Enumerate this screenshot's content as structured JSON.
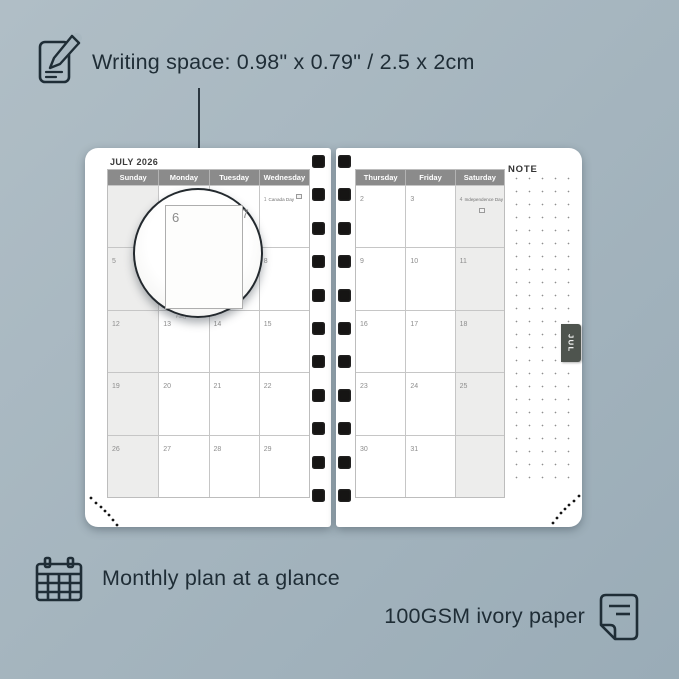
{
  "colors": {
    "background_start": "#b0bec6",
    "background_end": "#9aacb7",
    "ink": "#1f2d36",
    "calendar_header_gray": "#8b8b8b",
    "weekend_column_bg": "#ededec",
    "grid_line": "#c6c6c6",
    "day_number_gray": "#8d8d8d",
    "month_tab_bg": "#4e544e",
    "page_white": "#ffffff"
  },
  "annotations": {
    "writing_space": {
      "label": "Writing space: 0.98\" x 0.79\" / 2.5 x 2cm"
    },
    "monthly_plan": {
      "label": "Monthly plan at a glance"
    },
    "paper": {
      "label": "100GSM ivory paper"
    }
  },
  "planner": {
    "month_title": "JULY 2026",
    "note_label": "NOTE",
    "tab_label": "JUL",
    "left_page": {
      "day_headers": [
        "Sunday",
        "Monday",
        "Tuesday",
        "Wednesday"
      ],
      "weekend_col": 0,
      "rows": [
        [
          {
            "num": ""
          },
          {
            "num": ""
          },
          {
            "num": ""
          },
          {
            "num": "1",
            "event": "Canada Day",
            "flag": "inline"
          }
        ],
        [
          {
            "num": "5"
          },
          {
            "num": "6"
          },
          {
            "num": "7"
          },
          {
            "num": "8"
          }
        ],
        [
          {
            "num": "12"
          },
          {
            "num": "13",
            "note": "Full()"
          },
          {
            "num": "14"
          },
          {
            "num": "15"
          }
        ],
        [
          {
            "num": "19"
          },
          {
            "num": "20"
          },
          {
            "num": "21"
          },
          {
            "num": "22"
          }
        ],
        [
          {
            "num": "26"
          },
          {
            "num": "27"
          },
          {
            "num": "28"
          },
          {
            "num": "29"
          }
        ]
      ]
    },
    "right_page": {
      "day_headers": [
        "Thursday",
        "Friday",
        "Saturday"
      ],
      "weekend_col": 2,
      "rows": [
        [
          {
            "num": "2"
          },
          {
            "num": "3"
          },
          {
            "num": "4",
            "event": "Independence Day",
            "flag": "below"
          }
        ],
        [
          {
            "num": "9"
          },
          {
            "num": "10"
          },
          {
            "num": "11"
          }
        ],
        [
          {
            "num": "16"
          },
          {
            "num": "17"
          },
          {
            "num": "18"
          }
        ],
        [
          {
            "num": "23"
          },
          {
            "num": "24"
          },
          {
            "num": "25"
          }
        ],
        [
          {
            "num": "30"
          },
          {
            "num": "31"
          },
          {
            "num": ""
          }
        ]
      ]
    },
    "binding_holes_per_column": 11
  },
  "magnifier": {
    "zoom_day": "6",
    "adjacent_day": "7"
  }
}
